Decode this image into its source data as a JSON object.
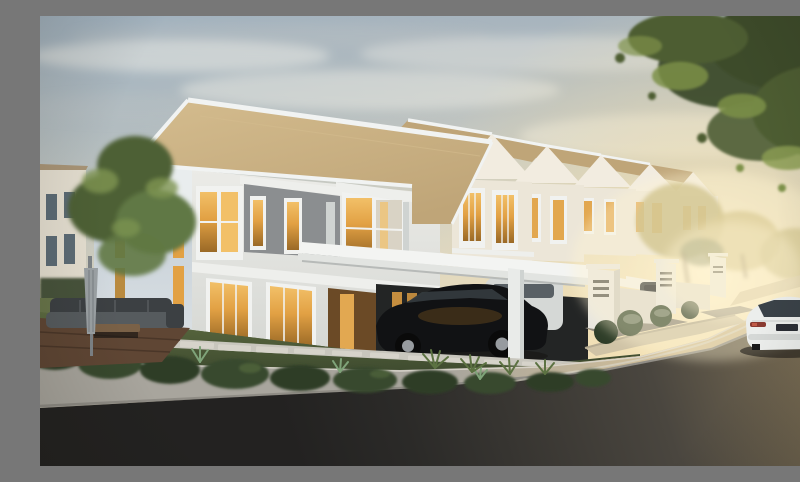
{
  "scene": {
    "description": "Dusk architectural rendering of a modern white two-storey corner terrace house with a row of identical terrace units receding to the right, warm amber interior lighting, a black SUV parked under the flat white carport canopy, a white sedan driving away on the curved street, landscaped lawn with stepping stones, shrubs, patio furniture with a folded umbrella, and a warm sunset glow behind trees",
    "time_of_day": "dusk / sunset",
    "weather": "hazy warm sky with soft clouds",
    "buildings": {
      "main_house": "two-storey white corner terrace unit, tan gable roof, grey upper accent panel, lit amber windows, glass ground-floor doors, attached flat white carport canopy",
      "row_houses": "row of matching gabled terrace units receding toward the sunset",
      "row_house_count": 6,
      "background_house": "cream house with dark windows at far left"
    },
    "vehicles": [
      "black SUV parked under main carport",
      "white car parked in neighbouring carport",
      "dark grey car in far driveway",
      "white sedan driving away on the street (rear view, dark plate, red tail lights)"
    ],
    "landscape": [
      "green tree at left",
      "overhanging green foliage top-right corner",
      "golden backlit small trees along street",
      "dark shrub hedge along lawn edge",
      "spiky accent plants",
      "stepping-stone path across lawn",
      "timber patio deck with grey outdoor sofa and folded umbrella",
      "curved concrete sidewalk and curb",
      "dark asphalt road with dashed lane markings and corner planting island"
    ]
  },
  "palette": {
    "sky-top": "#a7b4be",
    "sky-mid": "#d3d1c3",
    "sky-warm": "#eaddbe",
    "sky-low": "#f6e8c2",
    "sky-tint": "#9db0bf",
    "sun-core": "#fff4d2",
    "sun-glow": "#f7e2ac",
    "cloud-light": "#f7f4eb",
    "cloud-grey": "#b9bfc4",
    "roof-tan": "#bfa578",
    "roof-light": "#d4bc8e",
    "trim": "#f1f3f2",
    "gable-face": "#e9edee",
    "wall-front-top": "#ebebe7",
    "wall-front-bot": "#d5d7d3",
    "wall-side-top": "#c5cfd7",
    "wall-side-bot": "#dde2e5",
    "accent-grey": "#8b8e90",
    "frame": "#f1f2f0",
    "glass-top": "#f2c068",
    "glass-mid": "#e2a144",
    "glass-deep": "#9a6926",
    "glass-dim": "#b98a3f",
    "glass-pale": "#d9d3c5",
    "interior": "#6b4a26",
    "interior-bright": "#f0b356",
    "slab": "#eeefec",
    "canopy": "#f3f4f2",
    "fascia": "#e2e4e1",
    "canopy-under": "#b7bab8",
    "carport": "#232525",
    "column": "#e9ebe9",
    "column-shade": "#cfd3d1",
    "row-wall": "#ece6d8",
    "row-wall-lit": "#f2ece0",
    "row-window": "#e2a74f",
    "row-canopy": "#f4f0e6",
    "car-black": "#111214",
    "car-black-win": "#343a3d",
    "rim": "#979b9f",
    "car-white": "#eceeec",
    "car-white-shade": "#d5d8d6",
    "car-win": "#3a4248",
    "tail": "#8a3a30",
    "tail-bright": "#c05a46",
    "plate": "#2a2d34",
    "grey-car": "#3a3d3f",
    "lawn-top": "#5d6c41",
    "lawn-bot": "#39452c",
    "lawn-lit": "#68754a",
    "shrub-dark": "#2e3d28",
    "shrub-mid": "#37482e",
    "shrub-light": "#5c7242",
    "agave": "#7fa379",
    "stone": "#d6d3ca",
    "apron": "#c8c6bd",
    "deck": "#5f4634",
    "deck-line": "#4a3628",
    "sofa-dark": "#3c4043",
    "sofa-mid": "#565b5e",
    "table": "#7a6147",
    "umbrella": "#9ba1a4",
    "umbrella-shade": "#7e8488",
    "walk": "#a8a59d",
    "walk-warm": "#d2bf98",
    "curb": "#8f8c85",
    "curb-light": "#dedbd2",
    "island": "#cfc3a6",
    "island-curb": "#b5ab92",
    "road-warm": "#857659",
    "road-mid": "#4a463f",
    "road-dark": "#2b2a28",
    "road-deep": "#232221",
    "lane": "#d8d4c6",
    "drive": "#8f897c",
    "far-pave": "#cdbd98",
    "pillar": "#e8e6df",
    "pillar-shade": "#cfccc2",
    "wall-low": "#ddd9cf",
    "slot": "#54524c",
    "tree1": "#4e6136",
    "tree2": "#617844",
    "tree-light": "#7e9552",
    "fol-dark": "#3d4c2b",
    "fol-mid": "#4e5d33",
    "fol-light": "#7d9148",
    "fol-lighter": "#8a9c52",
    "gold1": "#b8a968",
    "gold2": "#c6b474",
    "trunk": "#6e5c42",
    "bg-wall": "#e4ded0",
    "bg-roof": "#a99577",
    "bg-win": "#5c6b75",
    "hedge": "#46523a",
    "shadow": "#141210"
  }
}
